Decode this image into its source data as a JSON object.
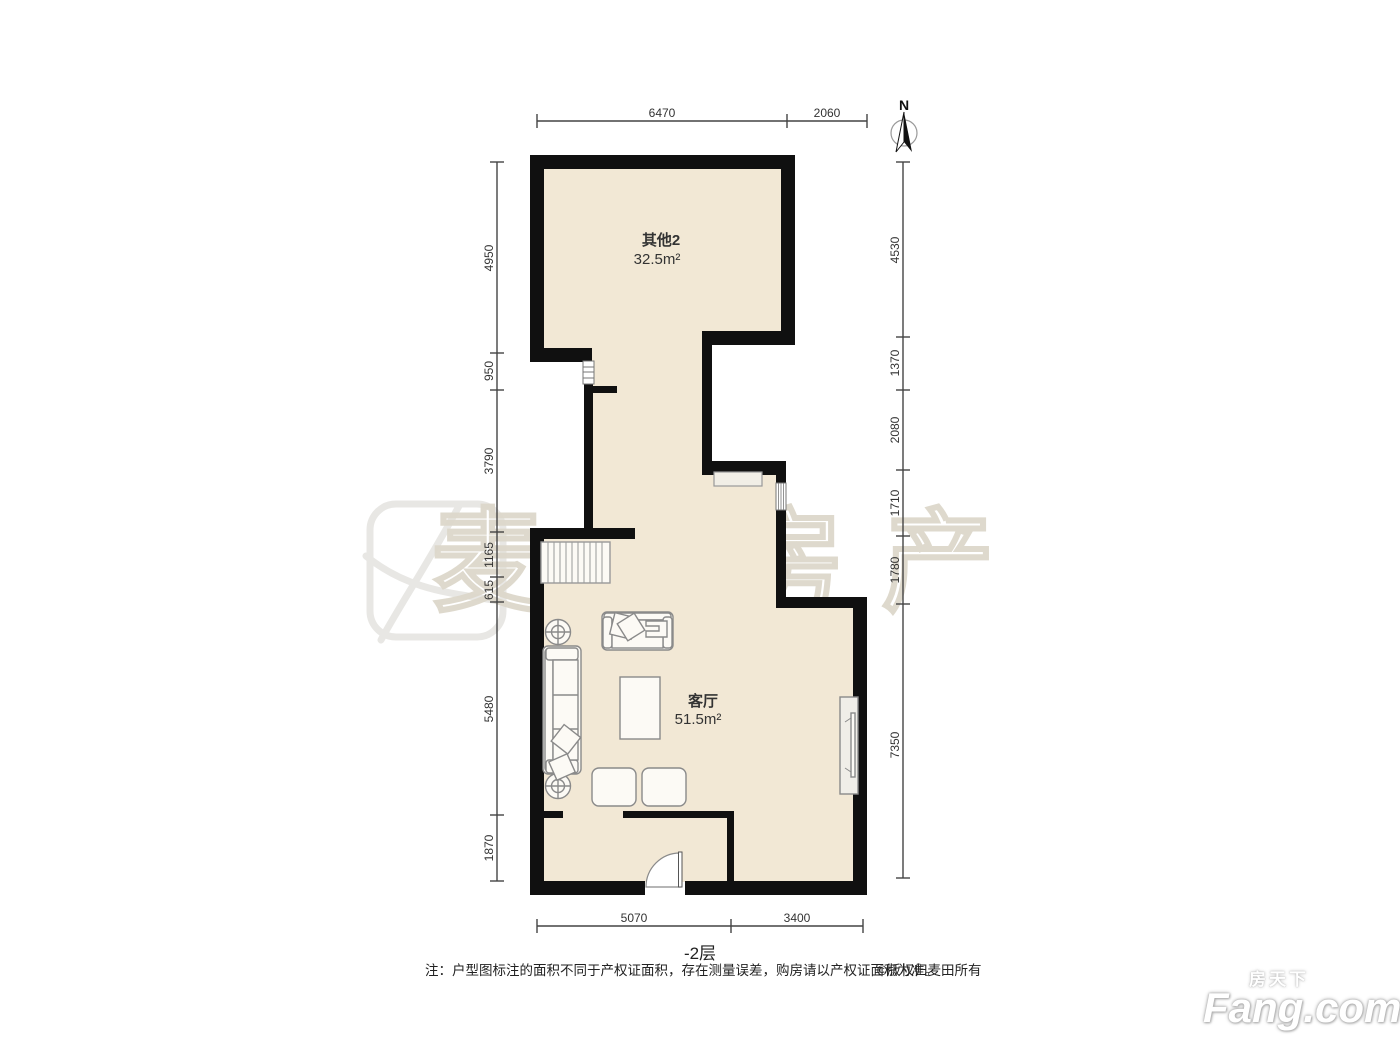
{
  "compass": {
    "north_label": "N"
  },
  "rooms": [
    {
      "name": "其他2",
      "area": "32.5m²"
    },
    {
      "name": "客厅",
      "area": "51.5m²"
    }
  ],
  "dimensions": {
    "top": [
      "6470",
      "2060"
    ],
    "bottom": [
      "5070",
      "3400"
    ],
    "left": [
      "4950",
      "950",
      "3790",
      "1165",
      "615",
      "5480",
      "1870"
    ],
    "right": [
      "4530",
      "1370",
      "2080",
      "1710",
      "1780",
      "7350"
    ]
  },
  "floor_label": "-2层",
  "note": "注：户型图标注的面积不同于产权证面积，存在测量误差，购房请以产权证面积为准。",
  "copyright": "©版权归麦田所有",
  "watermark": {
    "brand_text": "麦田房产",
    "fang_cn": "房天下",
    "fang_en": "Fang.com"
  },
  "colors": {
    "floor": "#f2e8d5",
    "wall": "#101010",
    "furniture_stroke": "#8a8a8a",
    "dimension": "#333333",
    "watermark_stroke": "#ded9cc"
  }
}
